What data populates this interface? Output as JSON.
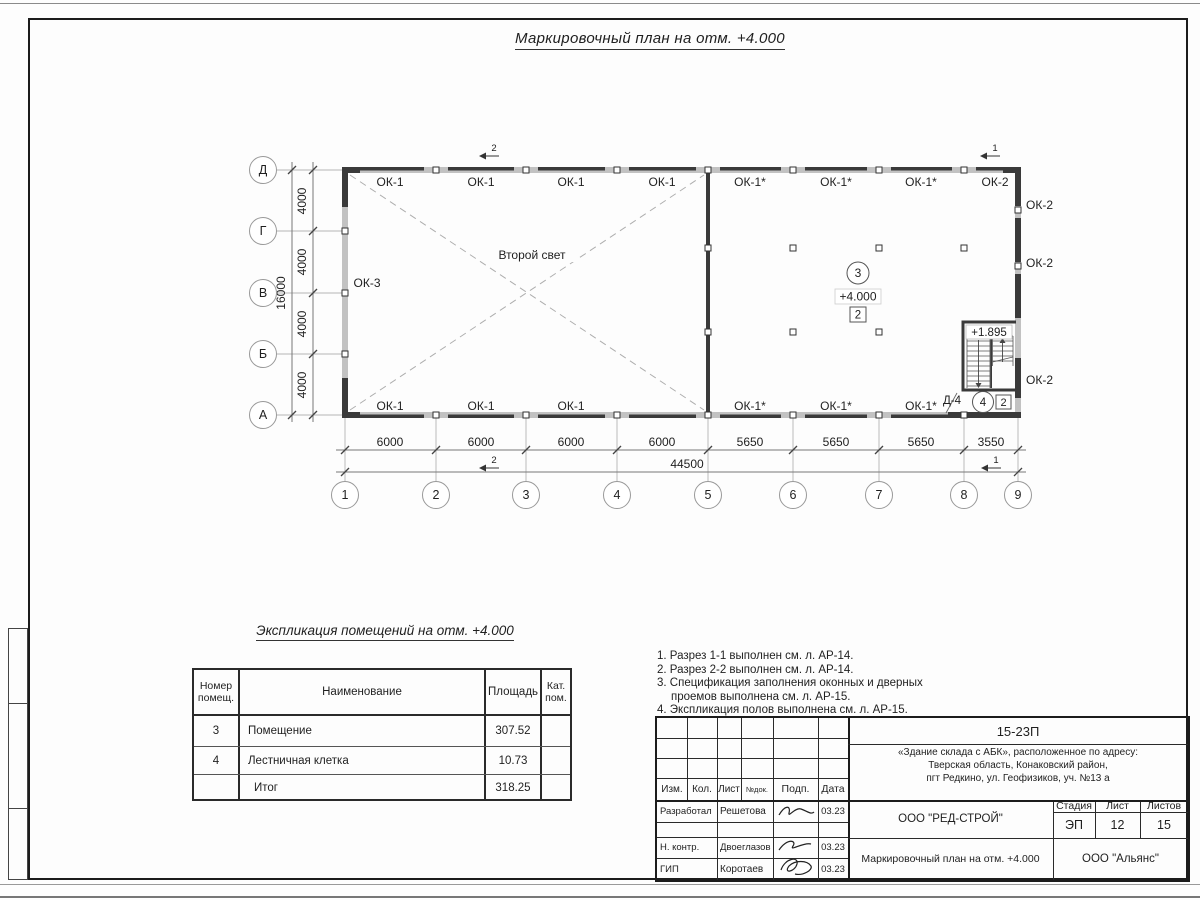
{
  "sheet": {
    "title": "Маркировочный план на отм. +4.000"
  },
  "colors": {
    "ink": "#1f1f1f",
    "wall_gray": "#c2c2c2",
    "window_dark": "#3a3a3a"
  },
  "plan": {
    "second_light_label": "Второй свет",
    "axes_cols": [
      "1",
      "2",
      "3",
      "4",
      "5",
      "6",
      "7",
      "8",
      "9"
    ],
    "axes_rows": [
      "Д",
      "Г",
      "В",
      "Б",
      "А"
    ],
    "dims_bottom": [
      "6000",
      "6000",
      "6000",
      "6000",
      "5650",
      "5650",
      "5650",
      "3550"
    ],
    "dim_bottom_total": "44500",
    "dims_left": [
      "4000",
      "4000",
      "4000",
      "4000"
    ],
    "dim_left_total": "16000",
    "win_top": [
      "ОК-1",
      "ОК-1",
      "ОК-1",
      "ОК-1",
      "ОК-1*",
      "ОК-1*",
      "ОК-1*",
      "ОК-2"
    ],
    "win_bottom": [
      "ОК-1",
      "ОК-1",
      "ОК-1",
      "ОК-1*",
      "ОК-1*",
      "ОК-1*"
    ],
    "win_left": "ОК-3",
    "win_right": [
      "ОК-2",
      "ОК-2",
      "ОК-2"
    ],
    "marks": {
      "s1": "1",
      "s2": "2"
    },
    "room3": {
      "num": "3",
      "elev": "+4.000",
      "type": "2"
    },
    "room4": {
      "num": "4",
      "type": "2",
      "door": "Д-4",
      "stair_elev": "+1.895"
    }
  },
  "explication": {
    "title": "Экспликация помещений на отм. +4.000",
    "headers": [
      "Номер помещ.",
      "Наименование",
      "Площадь",
      "Кат. пом."
    ],
    "rows": [
      [
        "3",
        "Помещение",
        "307.52",
        ""
      ],
      [
        "4",
        "Лестничная клетка",
        "10.73",
        ""
      ],
      [
        "",
        "Итог",
        "318.25",
        ""
      ]
    ]
  },
  "notes": [
    "1. Разрез 1-1 выполнен см. л. АР-14.",
    "2. Разрез 2-2 выполнен см. л. АР-14.",
    "3. Спецификация заполнения оконных и дверных",
    "проемов выполнена см. л. АР-15.",
    "4. Экспликация полов выполнена см. л. АР-15."
  ],
  "titleblock": {
    "doc_number": "15-23П",
    "address_lines": [
      "«Здание склада с АБК», расположенное по адресу:",
      "Тверская область, Конаковский район,",
      "пгт Редкино, ул. Геофизиков, уч. №13 а"
    ],
    "header_cells": [
      "Изм.",
      "Кол.",
      "Лист",
      "№док.",
      "Подп.",
      "Дата"
    ],
    "rows": [
      {
        "role": "Разработал",
        "name": "Решетова",
        "date": "03.23"
      },
      {
        "role": "Н. контр.",
        "name": "Двоеглазов",
        "date": "03.23"
      },
      {
        "role": "ГИП",
        "name": "Коротаев",
        "date": "03.23"
      }
    ],
    "company": "ООО \"РЕД-СТРОЙ\"",
    "sheet_title": "Маркировочный план на отм. +4.000",
    "stage_label": "Стадия",
    "sheet_label": "Лист",
    "sheets_label": "Листов",
    "stage": "ЭП",
    "sheet_num": "12",
    "sheets_total": "15",
    "org": "ООО \"Альянс\""
  }
}
